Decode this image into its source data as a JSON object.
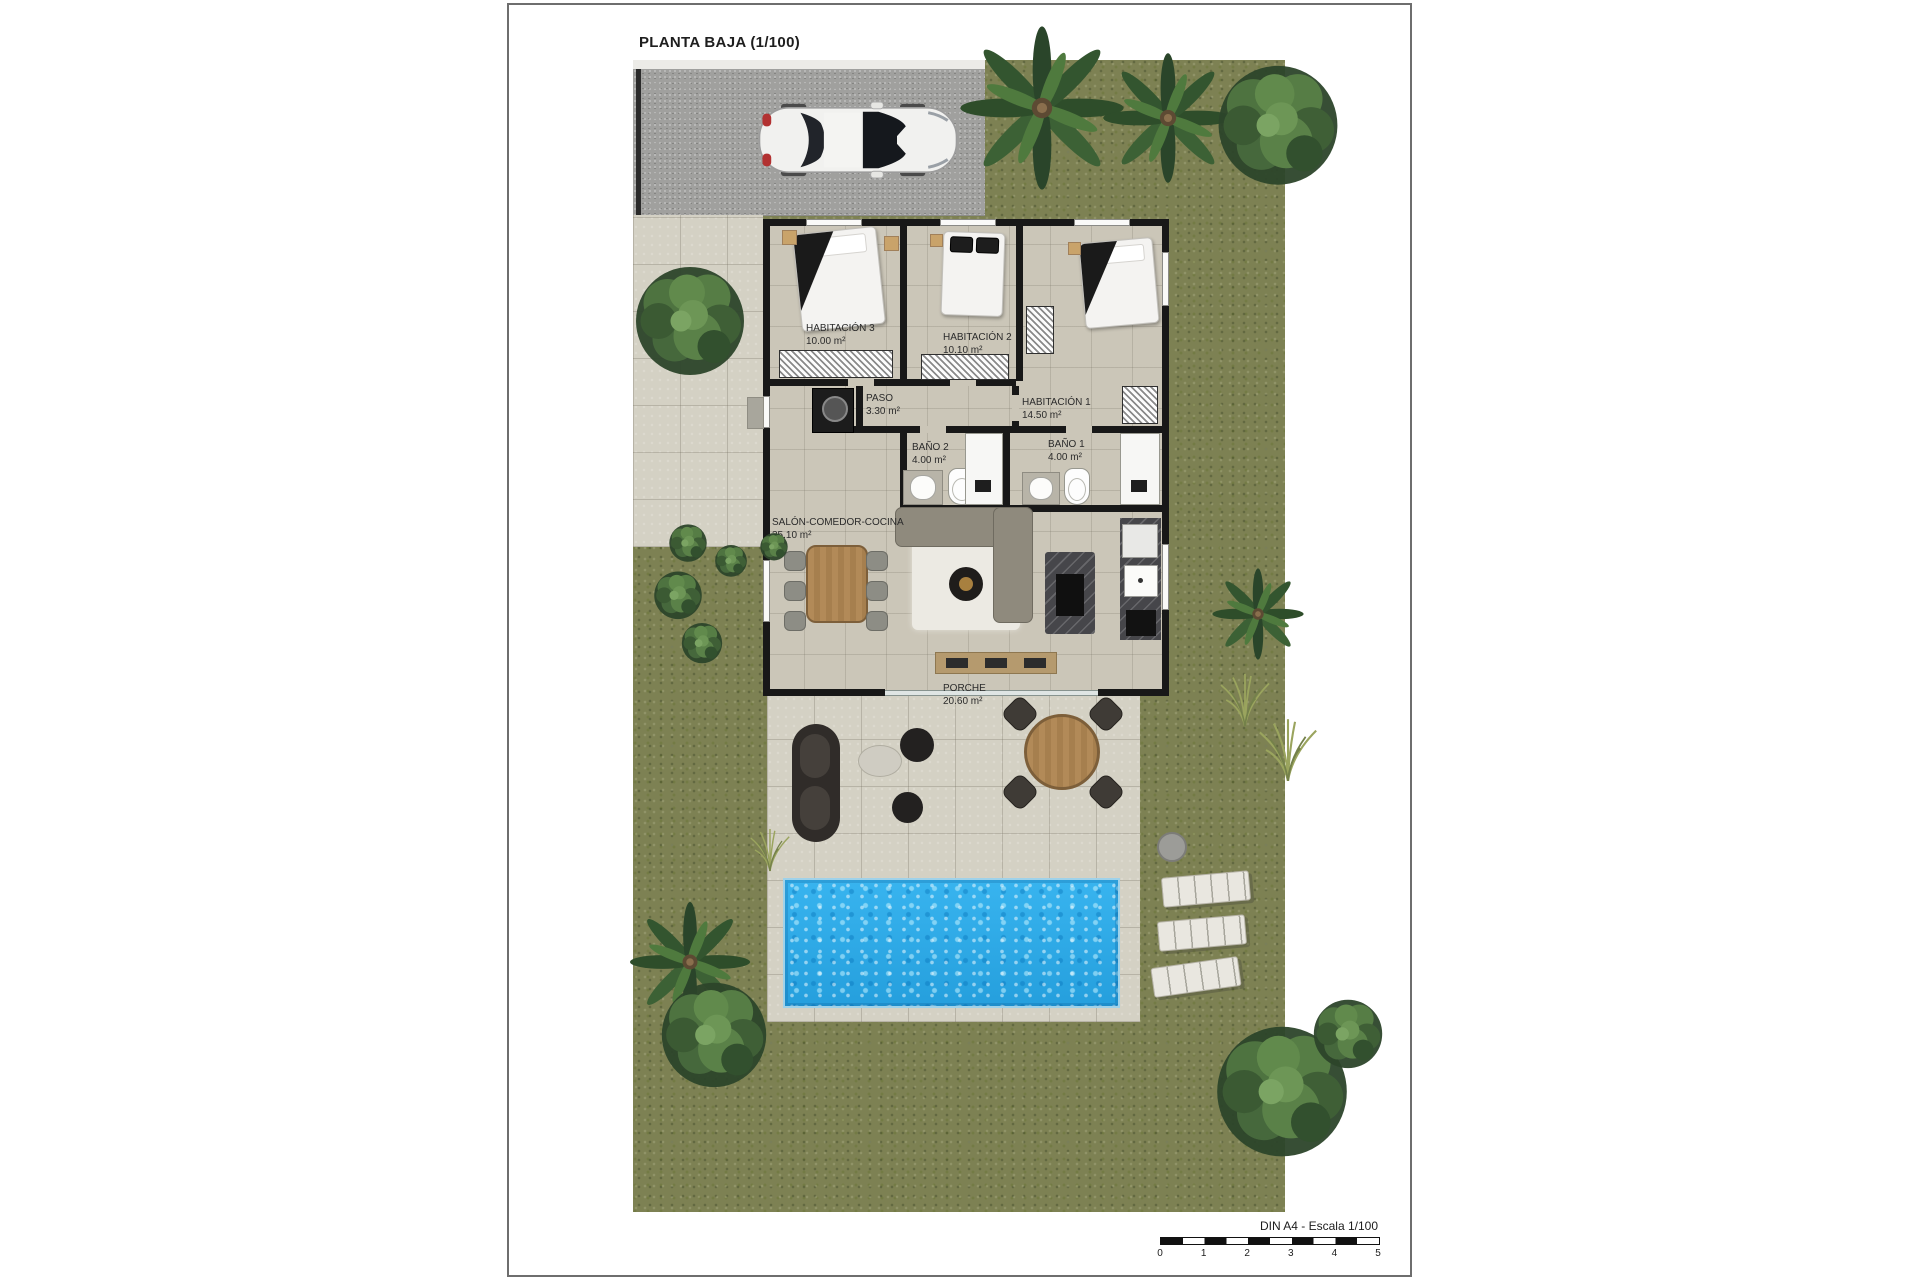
{
  "page": {
    "title": "PLANTA BAJA (1/100)"
  },
  "rooms": [
    {
      "name": "HABITACIÓN 3",
      "area": "10.00 m²"
    },
    {
      "name": "HABITACIÓN 2",
      "area": "10.10 m²"
    },
    {
      "name": "HABITACIÓN 1",
      "area": "14.50 m²"
    },
    {
      "name": "PASO",
      "area": "3.30 m²"
    },
    {
      "name": "BAÑO 2",
      "area": "4.00 m²"
    },
    {
      "name": "BAÑO 1",
      "area": "4.00 m²"
    },
    {
      "name": "SALÓN-COMEDOR-COCINA",
      "area": "35.10 m²"
    },
    {
      "name": "PORCHE",
      "area": "20.60 m²"
    }
  ],
  "scale_bar": {
    "label": "DIN A4 - Escala 1/100",
    "ticks": [
      "0",
      "1",
      "2",
      "3",
      "4",
      "5"
    ]
  },
  "colors": {
    "page_bg": "#ffffff",
    "grass": "#7d8153",
    "pool_water": "#2fa9e8",
    "concrete": "#d4d1c4",
    "garage_slab": "#a0a09e",
    "wall": "#181818"
  }
}
